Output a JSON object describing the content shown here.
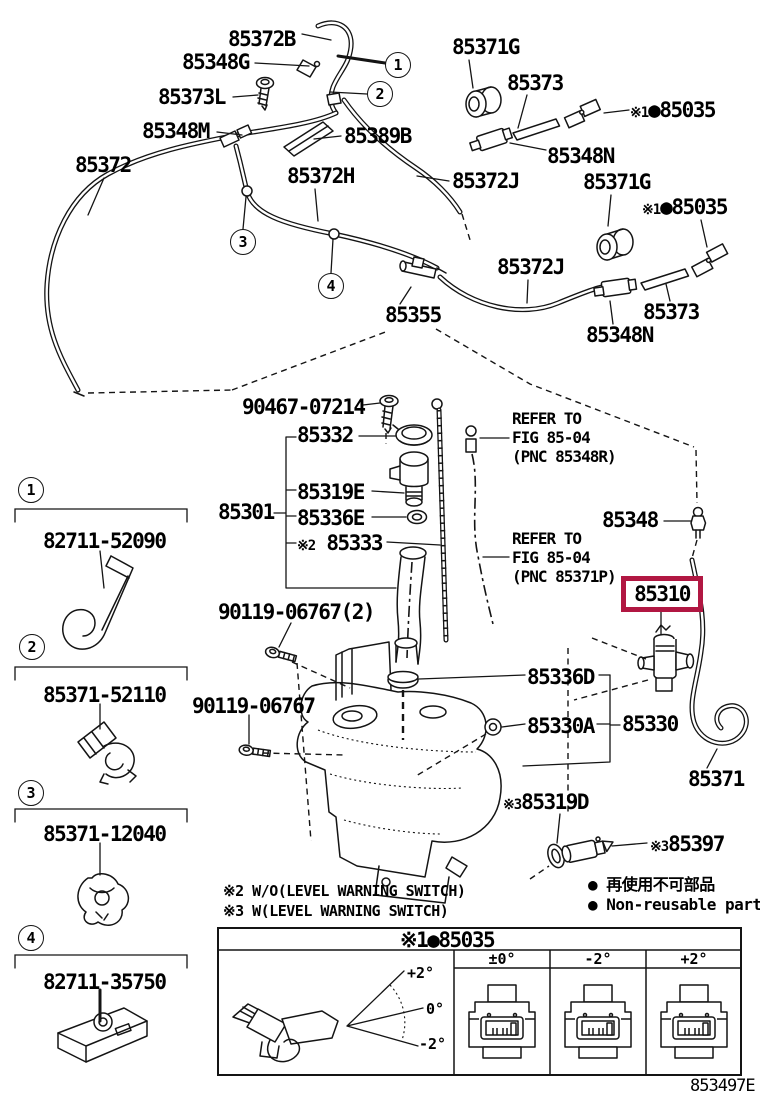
{
  "diagram": {
    "figure_code": "853497E",
    "accent_color": "#b11742",
    "parts": {
      "p85372B": "85372B",
      "p85348G": "85348G",
      "p85373L": "85373L",
      "p85348M": "85348M",
      "p85389B": "85389B",
      "p85372": "85372",
      "p85372H": "85372H",
      "p85371G": "85371G",
      "p85373": "85373",
      "p85348N": "85348N",
      "p85372J": "85372J",
      "p85355": "85355",
      "p90467": "90467-07214",
      "p85332": "85332",
      "p85319E": "85319E",
      "p85301": "85301",
      "p85336E": "85336E",
      "p85333": "85333",
      "p85348": "85348",
      "p85310": "85310",
      "p90119x2": "90119-06767(2)",
      "p90119": "90119-06767",
      "p85336D": "85336D",
      "p85330A": "85330A",
      "p85330": "85330",
      "p85371": "85371",
      "p85319D": "85319D",
      "p85397": "85397",
      "p85035": "●85035"
    },
    "marks": {
      "m1": "※1",
      "m2": "※2",
      "m3": "※3"
    },
    "refer_a": {
      "line1": "REFER TO",
      "line2": "FIG 85-04",
      "line3": "(PNC 85348R)"
    },
    "refer_b": {
      "line1": "REFER TO",
      "line2": "FIG 85-04",
      "line3": "(PNC 85371P)"
    },
    "callouts": {
      "n1": "1",
      "n2": "2",
      "n3": "3",
      "n4": "4"
    },
    "group_parts": {
      "g1": "82711-52090",
      "g2": "85371-52110",
      "g3": "85371-12040",
      "g4": "82711-35750"
    },
    "notes": {
      "w2": "※2 W/O(LEVEL WARNING SWITCH)",
      "w3": "※3 W(LEVEL WARNING SWITCH)",
      "reuse_bullet": "●",
      "reuse_jp": "再使用不可部品",
      "reuse_en": "Non-reusable part"
    },
    "table": {
      "header_mark": "※1",
      "header_part": "●85035",
      "columns": [
        "±0°",
        "-2°",
        "+2°"
      ],
      "angles": {
        "top": "+2°",
        "mid": "0°",
        "bottom": "-2°"
      }
    }
  }
}
